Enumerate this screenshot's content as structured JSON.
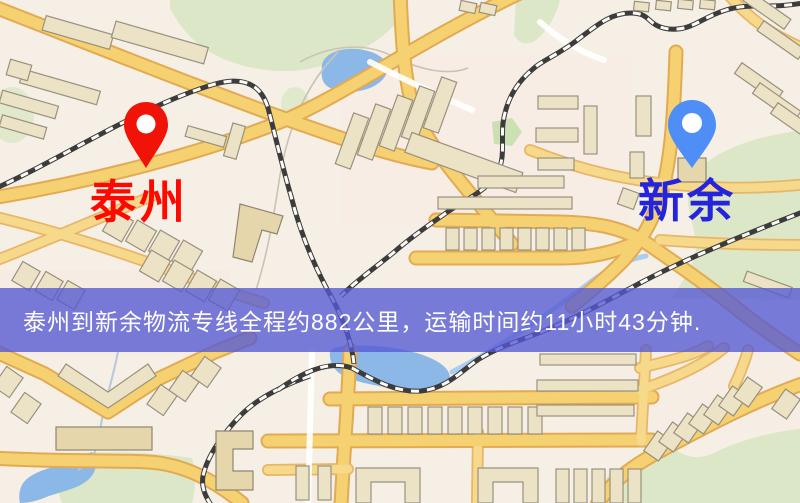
{
  "route_banner": {
    "text": "泰州到新余物流专线全程约882公里，运输时间约11小时43分钟.",
    "background_color": "#5458d4",
    "text_color": "#ffffff"
  },
  "markers": {
    "origin": {
      "label": "泰州",
      "label_color": "#ff0800",
      "pin_color": "#f01408"
    },
    "destination": {
      "label": "新余",
      "label_color": "#2424dc",
      "pin_color": "#4f8ef7"
    }
  },
  "route": {
    "from": "泰州",
    "to": "新余",
    "distance": "882公里",
    "duration": "11小时43分钟"
  },
  "map_palette": {
    "background": "#f6efe5",
    "road_fill": "#f6d171",
    "road_casing": "#e2aa52",
    "park_green": "#dbe7c6",
    "water_blue": "#8cb8e8",
    "building_fill": "#ece3c7",
    "railway": "#3c3c3c"
  }
}
